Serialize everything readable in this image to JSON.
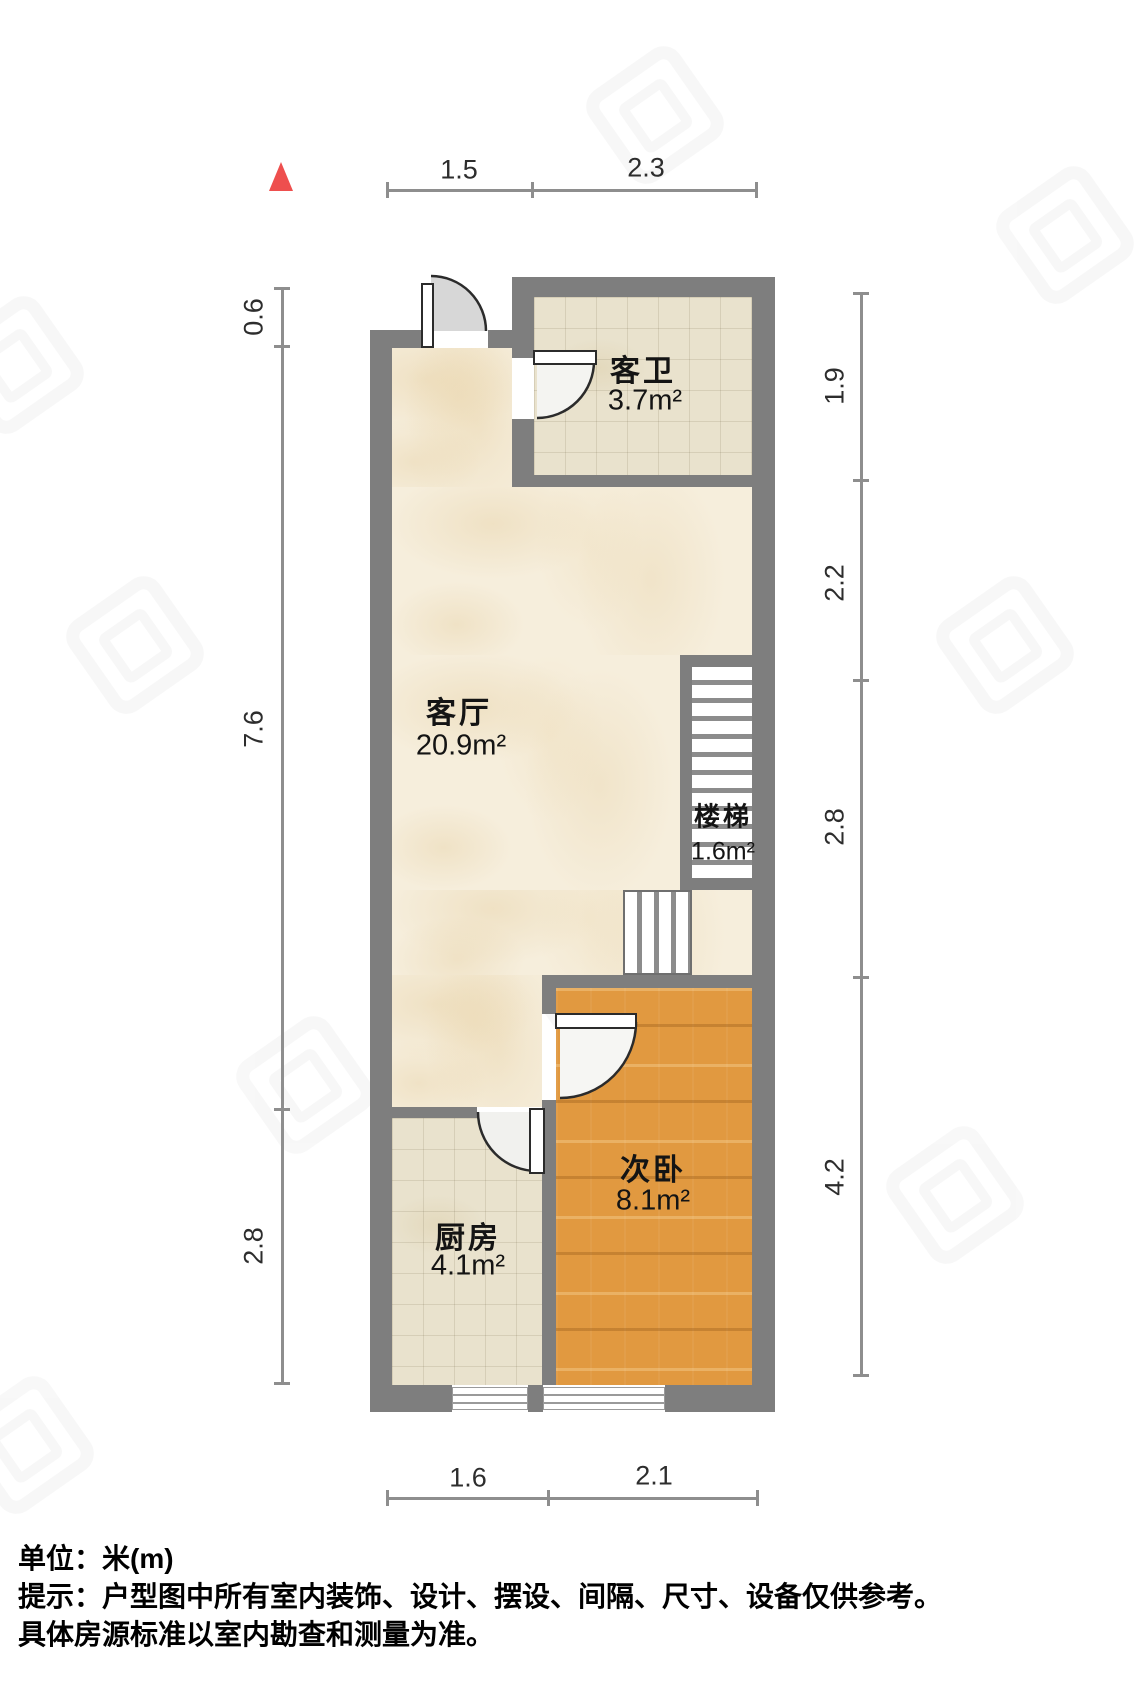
{
  "plan": {
    "title": "户型图",
    "unit": "米(m)"
  },
  "north_indicator": {
    "color": "#ee4f4e"
  },
  "rooms": [
    {
      "id": "living",
      "name": "客厅",
      "area": "20.9m²"
    },
    {
      "id": "bath",
      "name": "客卫",
      "area": "3.7m²"
    },
    {
      "id": "stairs",
      "name": "楼梯",
      "area": "1.6m²"
    },
    {
      "id": "bedroom",
      "name": "次卧",
      "area": "8.1m²"
    },
    {
      "id": "kitchen",
      "name": "厨房",
      "area": "4.1m²"
    }
  ],
  "dimensions": {
    "top": [
      "1.5",
      "2.3"
    ],
    "bottom": [
      "1.6",
      "2.1"
    ],
    "left": [
      "0.6",
      "7.6",
      "2.8"
    ],
    "right": [
      "1.9",
      "2.2",
      "2.8",
      "4.2"
    ]
  },
  "footer": {
    "unit_label": "单位：米(m)",
    "note_line1": "提示：户型图中所有室内装饰、设计、摆设、间隔、尺寸、设备仅供参考。",
    "note_line2": "具体房源标准以室内勘查和测量为准。"
  },
  "colors": {
    "wall": "#7e7e7e",
    "marble_floor": "#f6eedc",
    "tile_floor": "#e9e2cd",
    "wood_floor": "#e19940",
    "dimension_line": "#8e8e8e",
    "north_arrow": "#ee4f4e"
  }
}
